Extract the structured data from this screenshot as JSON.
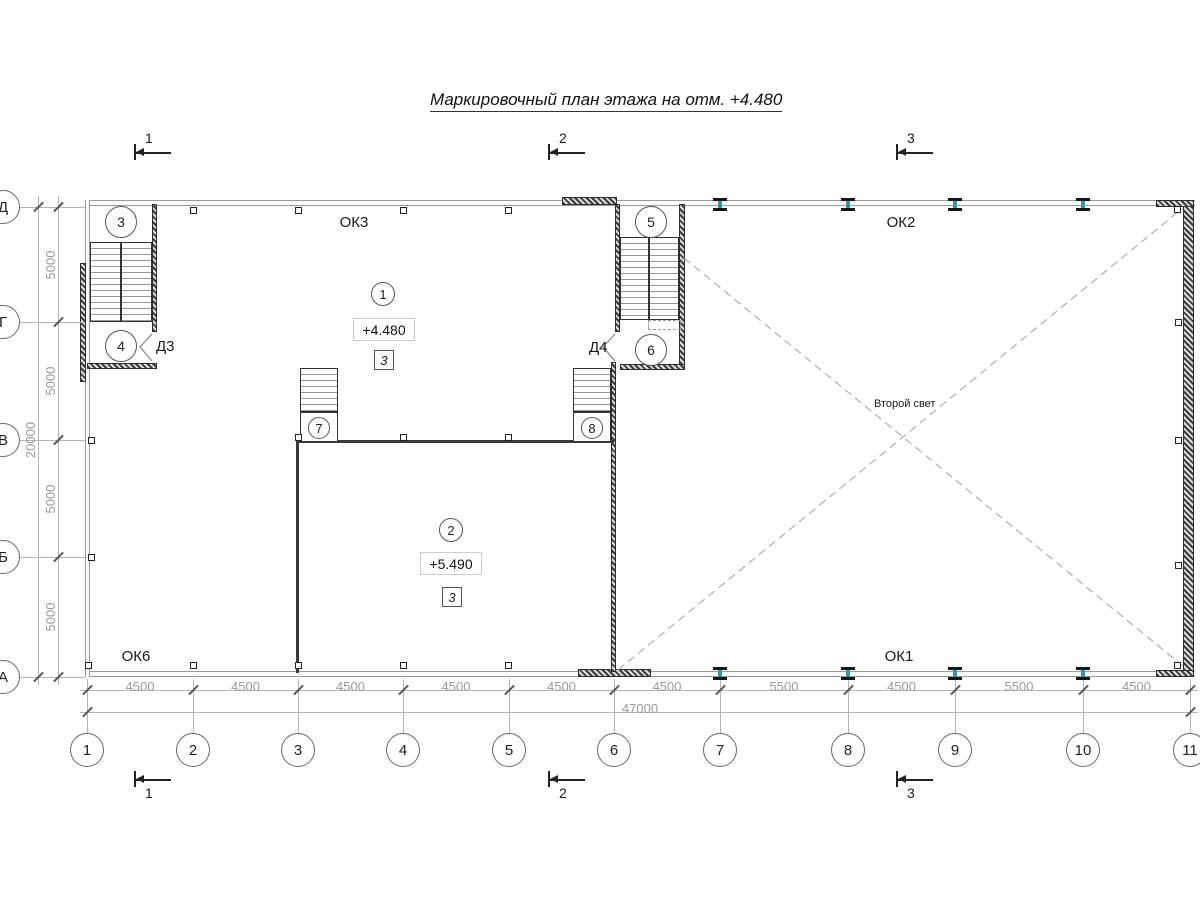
{
  "title": "Маркировочный план этажа на отм. +4.480",
  "grid": {
    "columns": [
      {
        "label": "1",
        "x": 87
      },
      {
        "label": "2",
        "x": 193
      },
      {
        "label": "3",
        "x": 298
      },
      {
        "label": "4",
        "x": 403
      },
      {
        "label": "5",
        "x": 509
      },
      {
        "label": "6",
        "x": 614
      },
      {
        "label": "7",
        "x": 720
      },
      {
        "label": "8",
        "x": 848
      },
      {
        "label": "9",
        "x": 955
      },
      {
        "label": "10",
        "x": 1083
      },
      {
        "label": "11",
        "x": 1190
      }
    ],
    "rows": [
      {
        "label": "Д",
        "y": 207
      },
      {
        "label": "Г",
        "y": 322
      },
      {
        "label": "В",
        "y": 440
      },
      {
        "label": "Б",
        "y": 557
      },
      {
        "label": "А",
        "y": 677
      }
    ],
    "col_dims": [
      "4500",
      "4500",
      "4500",
      "4500",
      "4500",
      "4500",
      "5500",
      "4500",
      "5500",
      "4500"
    ],
    "row_dims": [
      "5000",
      "5000",
      "5000",
      "5000"
    ],
    "total_width": "47000",
    "total_height": "20000"
  },
  "sections": [
    {
      "label": "1",
      "x": 135
    },
    {
      "label": "2",
      "x": 549
    },
    {
      "label": "3",
      "x": 897
    }
  ],
  "circle_marks": [
    {
      "label": "3",
      "x": 121,
      "y": 222,
      "r": 16
    },
    {
      "label": "4",
      "x": 121,
      "y": 346,
      "r": 16
    },
    {
      "label": "5",
      "x": 651,
      "y": 222,
      "r": 16
    },
    {
      "label": "6",
      "x": 651,
      "y": 350,
      "r": 16
    },
    {
      "label": "1",
      "x": 383,
      "y": 294,
      "r": 12
    },
    {
      "label": "2",
      "x": 451,
      "y": 530,
      "r": 12
    },
    {
      "label": "7",
      "x": 319,
      "y": 428,
      "r": 11
    },
    {
      "label": "8",
      "x": 592,
      "y": 428,
      "r": 11
    }
  ],
  "elevations": [
    {
      "text": "+4.480",
      "x": 383,
      "y": 329
    },
    {
      "text": "+5.490",
      "x": 450,
      "y": 563
    }
  ],
  "type_marks": [
    {
      "text": "3",
      "x": 383,
      "y": 359
    },
    {
      "text": "3",
      "x": 451,
      "y": 596
    }
  ],
  "windows": [
    {
      "label": "ОК3",
      "x": 354,
      "y": 223
    },
    {
      "label": "ОК2",
      "x": 901,
      "y": 223
    },
    {
      "label": "ОК6",
      "x": 136,
      "y": 657
    },
    {
      "label": "ОК1",
      "x": 899,
      "y": 657
    }
  ],
  "doors": [
    {
      "label": "Д3",
      "x": 168,
      "y": 346
    },
    {
      "label": "Д4",
      "x": 601,
      "y": 347
    }
  ],
  "void_label": {
    "text": "Второй свет"
  },
  "beams": {
    "xs": [
      720,
      848,
      955,
      1083
    ],
    "top_y": 198,
    "bottom_y": 667,
    "web_color": "#1fa0ad"
  },
  "markers": [
    [
      193,
      210
    ],
    [
      298,
      210
    ],
    [
      403,
      210
    ],
    [
      508,
      210
    ],
    [
      88,
      665
    ],
    [
      193,
      665
    ],
    [
      298,
      665
    ],
    [
      403,
      665
    ],
    [
      508,
      665
    ],
    [
      91,
      440
    ],
    [
      91,
      557
    ],
    [
      1177,
      209
    ],
    [
      1178,
      322
    ],
    [
      1178,
      440
    ],
    [
      1178,
      565
    ],
    [
      1177,
      665
    ],
    [
      298,
      437
    ],
    [
      403,
      437
    ],
    [
      508,
      437
    ]
  ],
  "colors": {
    "dark_line": "#333333",
    "light_line": "#b5b5b5",
    "dim_text": "#9a9a9a",
    "beam_web": "#1fa0ad"
  }
}
